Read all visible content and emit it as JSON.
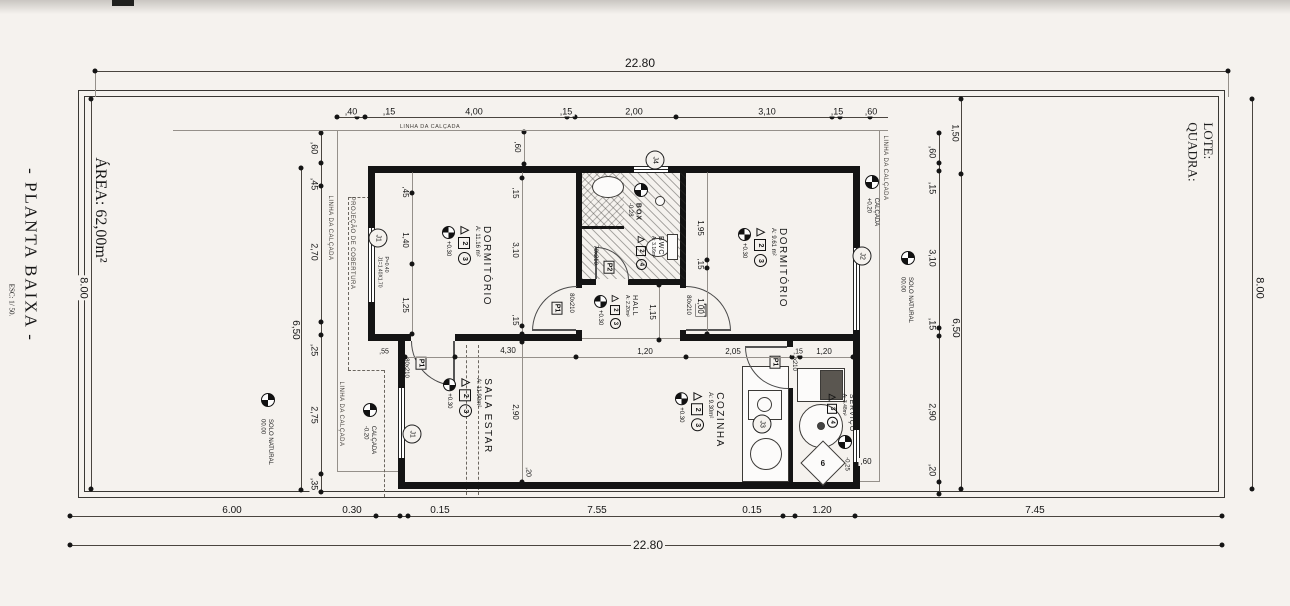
{
  "colors": {
    "background": "#f5f2ee",
    "ink": "#161616"
  },
  "titles": {
    "plan_title": "- PLANTA BAIXA -",
    "plan_scale": "ESC: 1/ 50.",
    "area": "ÁREA: 62,00m²",
    "quadra": "QUADRA:",
    "lote": "LOTE:"
  },
  "overall": {
    "top": "22.80",
    "bottom": "22.80",
    "left": "8.00",
    "right": "8.00"
  },
  "top_chain": {
    "d1": ",40",
    "d2": ",15",
    "d3": "4,00",
    "d4": ",15",
    "d5": "2,00",
    "d6": "3,10",
    "d7": ",15",
    "d8": ",60",
    "recuo": ",60"
  },
  "bottom_chain": {
    "d1": "6.00",
    "d2": "0.30",
    "d3": "0.15",
    "d4": "7.55",
    "d5": "0.15",
    "d6": "1.20",
    "d7": "7.45"
  },
  "left_chain": {
    "d1": ",60",
    "d2": ",45",
    "d3": "2,70",
    "d4": ",25",
    "d5": "2,75",
    "d6": ",35",
    "total": "6,50"
  },
  "right_chain": {
    "top": "1,50",
    "d1": ",60",
    "d2": ",15",
    "d3": "3,10",
    "d4": ",15",
    "d5": "2,90",
    "d6": ",20",
    "total": "6,50"
  },
  "interior": {
    "dorm1_l1": ",45",
    "dorm1_l2": "1,40",
    "dorm1_l3": "1,25",
    "dorm1_r1": ",15",
    "dorm1_r2": "3,10",
    "dorm1_r3": ",15",
    "dorm2_1": "1,95",
    "dorm2_2": ",15",
    "dorm2_3": "1,00",
    "hall_h": "1,15",
    "entry_off": ",55",
    "sala_w": "4,30",
    "hall_w": "1,20",
    "coz_w": "2,05",
    "serv_t": ",15",
    "serv_w": "1,20",
    "sala_h": "2,90",
    "wall_b": ",20",
    "serv_win": ",60"
  },
  "notes": {
    "calcada": "LINHA DA CALÇADA",
    "projecao": "PROJEÇÃO DE COBERTURA",
    "janela1": "J1=1.40X1.70",
    "janela2": "P=0.40"
  },
  "levels": {
    "calcada_right_val": "+0.20",
    "calcada_right_name": "CALÇADA",
    "calcada_left_val": "-0.20",
    "calcada_left_name": "CALÇADA",
    "solo_val": "00.00",
    "solo_name": "SOLO NATURAL",
    "servico_val": "-0.25",
    "box_val": "-0.28",
    "box_name": "BOX"
  },
  "rooms": {
    "dorm1": {
      "name": "DORMITÓRIO",
      "area": "A: 11.16 m²",
      "level": "+0.30",
      "tri": "△",
      "sq": "2",
      "circ": "3"
    },
    "dorm2": {
      "name": "DORMITÓRIO",
      "area": "A: 9.61 m²",
      "level": "+0.30",
      "tri": "△",
      "sq": "2",
      "circ": "3"
    },
    "sala": {
      "name": "SALA ESTAR",
      "area": "A: 11.90m²",
      "level": "+0.30",
      "tri": "△",
      "sq": "2",
      "circ": "3"
    },
    "cozinha": {
      "name": "COZINHA",
      "area": "A: 9.30m²",
      "level": "+0.30",
      "tri": "△",
      "sq": "2",
      "circ": "3"
    },
    "hall": {
      "name": "HALL",
      "area": "A: 2.20m²",
      "level": "+0.30",
      "tri": "△",
      "sq": "2",
      "circ": "3"
    },
    "bwc": {
      "name": "BWC",
      "area": "A: 3.16m²",
      "tri": "△",
      "sq": "2",
      "circ": "4"
    },
    "servico": {
      "name": "SERVIÇO",
      "area": "A: 3.48m²",
      "tri": "△",
      "sq": "3",
      "circ": "4"
    }
  },
  "doors": {
    "p1": "P1",
    "p2": "P2",
    "s80": "80x210",
    "s70": "70x210"
  },
  "windows": {
    "j1": "J1",
    "j2": "J2",
    "j3": "J3",
    "j4": "J4"
  },
  "extra": {
    "diamond": "6"
  }
}
